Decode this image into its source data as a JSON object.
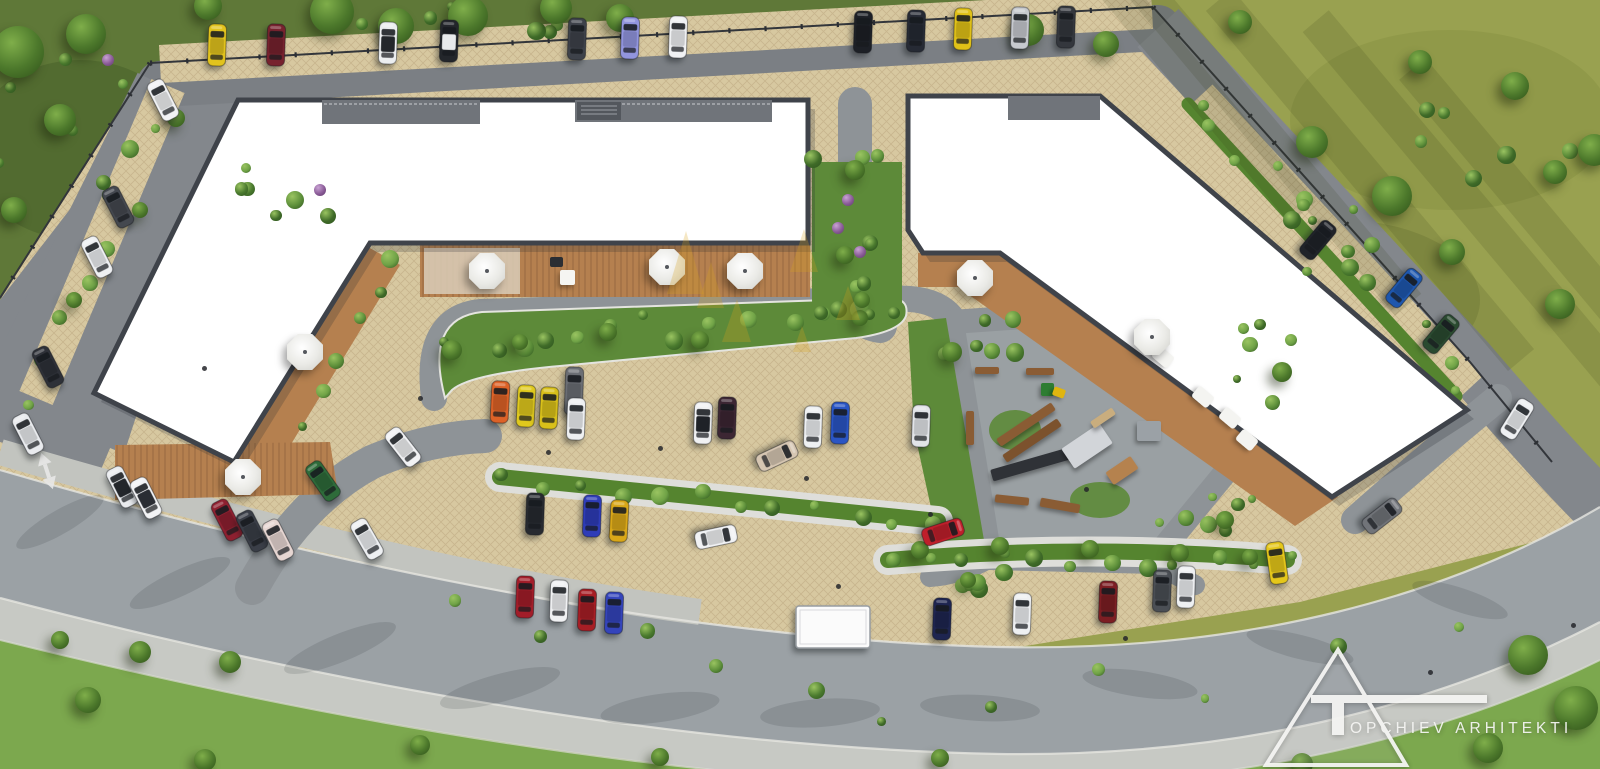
{
  "meta": {
    "width": 1600,
    "height": 769,
    "description": "Aerial 3D site plan rendering of residential complex with parking, gardens and playground"
  },
  "palette": {
    "grass_top_left": "#5f7838",
    "grass_top_right": "#99a150",
    "grass_bottom": "#7ca84e",
    "road_top": "#7b7f84",
    "road": "#83878c",
    "lane": "#8e9397",
    "pad": "#9aa0a3",
    "boulevard": "#9ba1a5",
    "sidewalk": "#c7c9c4",
    "paving": "#d7c8a0",
    "paving_line": "#c3b088",
    "deck": "#b5804f",
    "building": "#ffffff",
    "building_edge": "#3f434a",
    "hedge": "#55842f",
    "garden": "#5d8a39",
    "bush_light": "#9ac461",
    "bush_dark": "#2e531f",
    "flower_purple": "#8a5b97",
    "umbrella": "#f6f6f4",
    "wood": "#8a5c34",
    "watermark": "#d9a41c"
  },
  "logo": {
    "full_name": "TOPCHIEV ARHITEKTI",
    "monogram": "T",
    "text": "OPCHIEV ARHITEKTI"
  },
  "scene": {
    "cars": [
      {
        "x": 217,
        "y": 45,
        "a": 2,
        "c": "#e2c31d"
      },
      {
        "x": 276,
        "y": 45,
        "a": 2,
        "c": "#77222e"
      },
      {
        "x": 388,
        "y": 43,
        "a": 2,
        "c": "#eceef0",
        "r": "#23262b"
      },
      {
        "x": 449,
        "y": 41,
        "a": 2,
        "c": "#23262b",
        "r": "#e8eaec"
      },
      {
        "x": 577,
        "y": 39,
        "a": 2,
        "c": "#3e424a"
      },
      {
        "x": 630,
        "y": 38,
        "a": 2,
        "c": "#9295de"
      },
      {
        "x": 678,
        "y": 37,
        "a": 2,
        "c": "#f0f1f3"
      },
      {
        "x": 863,
        "y": 32,
        "a": 2,
        "c": "#1d2026"
      },
      {
        "x": 916,
        "y": 31,
        "a": 2,
        "c": "#262a34"
      },
      {
        "x": 963,
        "y": 29,
        "a": 2,
        "c": "#e0c117"
      },
      {
        "x": 1020,
        "y": 28,
        "a": 2,
        "c": "#c6c9ce"
      },
      {
        "x": 1066,
        "y": 27,
        "a": 2,
        "c": "#34373d"
      },
      {
        "x": 163,
        "y": 100,
        "a": -27,
        "c": "#f1f2f4"
      },
      {
        "x": 118,
        "y": 207,
        "a": -27,
        "c": "#44484f"
      },
      {
        "x": 97,
        "y": 257,
        "a": -27,
        "c": "#eef0f2"
      },
      {
        "x": 48,
        "y": 367,
        "a": -27,
        "c": "#2e3138"
      },
      {
        "x": 28,
        "y": 434,
        "a": -27,
        "c": "#e9ebee"
      },
      {
        "x": 122,
        "y": 487,
        "a": -27,
        "c": "#eaecef",
        "r": "#23262b"
      },
      {
        "x": 146,
        "y": 498,
        "a": -27,
        "c": "#f2f3f5",
        "r": "#2a2d33"
      },
      {
        "x": 227,
        "y": 520,
        "a": -27,
        "c": "#8e2030"
      },
      {
        "x": 252,
        "y": 531,
        "a": -27,
        "c": "#3a3e47"
      },
      {
        "x": 278,
        "y": 540,
        "a": -27,
        "c": "#e6d6d2"
      },
      {
        "x": 323,
        "y": 481,
        "a": -35,
        "c": "#2e6b3a"
      },
      {
        "x": 403,
        "y": 447,
        "a": -38,
        "c": "#f1f2f4"
      },
      {
        "x": 367,
        "y": 539,
        "a": -30,
        "c": "#eef0f2"
      },
      {
        "x": 500,
        "y": 402,
        "a": 3,
        "c": "#dd6227"
      },
      {
        "x": 526,
        "y": 406,
        "a": 3,
        "c": "#e0c91d"
      },
      {
        "x": 549,
        "y": 408,
        "a": 3,
        "c": "#d9c01a"
      },
      {
        "x": 574,
        "y": 391,
        "a": 2,
        "c": "#6b6e74",
        "h": 48
      },
      {
        "x": 576,
        "y": 419,
        "a": 2,
        "c": "#eef0f2"
      },
      {
        "x": 703,
        "y": 423,
        "a": 2,
        "c": "#f0f1f3",
        "r": "#1f2227"
      },
      {
        "x": 727,
        "y": 418,
        "a": 2,
        "c": "#3c2633"
      },
      {
        "x": 777,
        "y": 456,
        "a": 65,
        "c": "#d6c6b2"
      },
      {
        "x": 813,
        "y": 427,
        "a": 2,
        "c": "#eef0f2"
      },
      {
        "x": 840,
        "y": 423,
        "a": 2,
        "c": "#2a55c4"
      },
      {
        "x": 921,
        "y": 426,
        "a": 2,
        "c": "#e2e4e8"
      },
      {
        "x": 535,
        "y": 514,
        "a": 2,
        "c": "#272a30"
      },
      {
        "x": 592,
        "y": 516,
        "a": 2,
        "c": "#2e3cb8"
      },
      {
        "x": 619,
        "y": 521,
        "a": 3,
        "c": "#d9a718"
      },
      {
        "x": 716,
        "y": 537,
        "a": 78,
        "c": "#f1f2f4"
      },
      {
        "x": 525,
        "y": 597,
        "a": 2,
        "c": "#a21d29"
      },
      {
        "x": 559,
        "y": 601,
        "a": 2,
        "c": "#f0f1f3"
      },
      {
        "x": 587,
        "y": 610,
        "a": 2,
        "c": "#a71e25"
      },
      {
        "x": 614,
        "y": 613,
        "a": 2,
        "c": "#3444bb"
      },
      {
        "x": 942,
        "y": 619,
        "a": 2,
        "c": "#1e2550"
      },
      {
        "x": 1022,
        "y": 614,
        "a": 2,
        "c": "#eef0f2"
      },
      {
        "x": 1108,
        "y": 602,
        "a": 2,
        "c": "#7c1e23"
      },
      {
        "x": 1162,
        "y": 591,
        "a": 2,
        "c": "#4b4f55"
      },
      {
        "x": 1186,
        "y": 587,
        "a": 2,
        "c": "#eef0f2"
      },
      {
        "x": 1277,
        "y": 563,
        "a": -8,
        "c": "#e5c71a"
      },
      {
        "x": 943,
        "y": 532,
        "a": 72,
        "c": "#bf1f2b"
      },
      {
        "x": 833,
        "y": 627,
        "a": 0,
        "c": "#fbfbfb",
        "t": "box",
        "w": 74,
        "h": 42
      },
      {
        "x": 1318,
        "y": 240,
        "a": 40,
        "c": "#202329"
      },
      {
        "x": 1404,
        "y": 288,
        "a": 40,
        "c": "#1e57ae"
      },
      {
        "x": 1441,
        "y": 334,
        "a": 40,
        "c": "#2a4a30"
      },
      {
        "x": 1517,
        "y": 419,
        "a": 32,
        "c": "#eef0f2"
      },
      {
        "x": 1382,
        "y": 516,
        "a": 52,
        "c": "#717479"
      }
    ],
    "umbrellas": [
      {
        "x": 487,
        "y": 271
      },
      {
        "x": 667,
        "y": 267
      },
      {
        "x": 745,
        "y": 271
      },
      {
        "x": 305,
        "y": 352
      },
      {
        "x": 243,
        "y": 477
      },
      {
        "x": 975,
        "y": 278
      },
      {
        "x": 1152,
        "y": 337
      }
    ],
    "tables": [
      {
        "x": 567,
        "y": 277
      }
    ],
    "grills": [
      {
        "x": 556,
        "y": 262
      }
    ],
    "furniture": [
      {
        "x": 1163,
        "y": 357
      },
      {
        "x": 1203,
        "y": 397
      },
      {
        "x": 1230,
        "y": 418
      },
      {
        "x": 1247,
        "y": 440
      }
    ],
    "playground": [
      {
        "x": 1026,
        "y": 424,
        "w": 66,
        "h": 9,
        "a": -34,
        "c": "#8a5c34"
      },
      {
        "x": 1032,
        "y": 440,
        "w": 66,
        "h": 9,
        "a": -34,
        "c": "#7c522d"
      },
      {
        "x": 1036,
        "y": 463,
        "w": 92,
        "h": 12,
        "a": -16,
        "c": "#2f3237"
      },
      {
        "x": 1087,
        "y": 446,
        "w": 46,
        "h": 24,
        "a": -34,
        "c": "#d2d5d9"
      },
      {
        "x": 1122,
        "y": 470,
        "w": 30,
        "h": 15,
        "a": -34,
        "c": "#b5824e"
      },
      {
        "x": 1149,
        "y": 431,
        "w": 24,
        "h": 20,
        "a": 0,
        "c": "#9ba1a6"
      },
      {
        "x": 1047,
        "y": 389,
        "w": 13,
        "h": 13,
        "a": 0,
        "c": "#2e7d32"
      },
      {
        "x": 1059,
        "y": 392,
        "w": 12,
        "h": 9,
        "a": 20,
        "c": "#e0b50f"
      },
      {
        "x": 1012,
        "y": 500,
        "w": 34,
        "h": 8,
        "a": 6,
        "c": "#8a5c34"
      },
      {
        "x": 970,
        "y": 428,
        "w": 8,
        "h": 34,
        "a": 0,
        "c": "#8a5c34"
      },
      {
        "x": 1040,
        "y": 371,
        "w": 28,
        "h": 7,
        "a": 0,
        "c": "#8a5c34"
      },
      {
        "x": 987,
        "y": 370,
        "w": 24,
        "h": 7,
        "a": 0,
        "c": "#8a5c34"
      },
      {
        "x": 1103,
        "y": 418,
        "w": 26,
        "h": 8,
        "a": -34,
        "c": "#c9ad7e"
      },
      {
        "x": 1060,
        "y": 505,
        "w": 40,
        "h": 9,
        "a": 10,
        "c": "#8a5c34"
      }
    ],
    "trees": [
      {
        "x": 332,
        "y": 12,
        "s": 22
      },
      {
        "x": 396,
        "y": 26,
        "s": 18
      },
      {
        "x": 468,
        "y": 16,
        "s": 20
      },
      {
        "x": 556,
        "y": 8,
        "s": 16
      },
      {
        "x": 620,
        "y": 18,
        "s": 14
      },
      {
        "x": 208,
        "y": 6,
        "s": 14
      },
      {
        "x": 18,
        "y": 52,
        "s": 26
      },
      {
        "x": 86,
        "y": 34,
        "s": 20
      },
      {
        "x": 60,
        "y": 120,
        "s": 16
      },
      {
        "x": 14,
        "y": 210,
        "s": 13
      },
      {
        "x": 1028,
        "y": 30,
        "s": 16
      },
      {
        "x": 1106,
        "y": 44,
        "s": 13
      },
      {
        "x": 1392,
        "y": 196,
        "s": 20
      },
      {
        "x": 1312,
        "y": 142,
        "s": 16
      },
      {
        "x": 1452,
        "y": 252,
        "s": 13
      },
      {
        "x": 1560,
        "y": 304,
        "s": 15
      },
      {
        "x": 1515,
        "y": 86,
        "s": 14
      },
      {
        "x": 1420,
        "y": 62,
        "s": 12
      },
      {
        "x": 1594,
        "y": 150,
        "s": 16
      },
      {
        "x": 1240,
        "y": 22,
        "s": 12
      },
      {
        "x": 1555,
        "y": 172,
        "s": 12
      },
      {
        "x": 1528,
        "y": 655,
        "s": 20
      },
      {
        "x": 1576,
        "y": 708,
        "s": 22
      },
      {
        "x": 1488,
        "y": 748,
        "s": 15
      },
      {
        "x": 1302,
        "y": 764,
        "s": 11
      },
      {
        "x": 140,
        "y": 652,
        "s": 11
      },
      {
        "x": 88,
        "y": 700,
        "s": 13
      },
      {
        "x": 60,
        "y": 640,
        "s": 9
      },
      {
        "x": 230,
        "y": 662,
        "s": 11
      },
      {
        "x": 420,
        "y": 745,
        "s": 10
      },
      {
        "x": 660,
        "y": 757,
        "s": 9
      },
      {
        "x": 940,
        "y": 758,
        "s": 9
      },
      {
        "x": 205,
        "y": 760,
        "s": 11
      },
      {
        "x": 452,
        "y": 350,
        "s": 10
      },
      {
        "x": 700,
        "y": 340,
        "s": 9
      },
      {
        "x": 608,
        "y": 332,
        "s": 9
      },
      {
        "x": 520,
        "y": 342,
        "s": 8
      },
      {
        "x": 860,
        "y": 318,
        "s": 8
      },
      {
        "x": 920,
        "y": 550,
        "s": 9
      },
      {
        "x": 1000,
        "y": 546,
        "s": 9
      },
      {
        "x": 1090,
        "y": 549,
        "s": 9
      },
      {
        "x": 1180,
        "y": 553,
        "s": 9
      },
      {
        "x": 1250,
        "y": 557,
        "s": 8
      },
      {
        "x": 176,
        "y": 118,
        "s": 9
      },
      {
        "x": 140,
        "y": 210,
        "s": 8
      },
      {
        "x": 74,
        "y": 300,
        "s": 8
      },
      {
        "x": 952,
        "y": 352,
        "s": 10
      },
      {
        "x": 1282,
        "y": 372,
        "s": 10
      },
      {
        "x": 1225,
        "y": 520,
        "s": 9
      },
      {
        "x": 968,
        "y": 580,
        "s": 8
      },
      {
        "x": 855,
        "y": 170,
        "s": 10
      },
      {
        "x": 845,
        "y": 255,
        "s": 9
      },
      {
        "x": 862,
        "y": 300,
        "s": 8
      }
    ],
    "bush_clusters": [
      {
        "x": 60,
        "y": 80,
        "rx": 120,
        "ry": 110,
        "n": 10
      },
      {
        "x": 480,
        "y": 20,
        "rx": 190,
        "ry": 14,
        "n": 8
      },
      {
        "x": 852,
        "y": 235,
        "rx": 40,
        "ry": 80,
        "n": 10
      },
      {
        "line": [
          455,
          345,
          885,
          315
        ],
        "n": 14,
        "w": 16
      },
      {
        "line": [
          505,
          477,
          935,
          521
        ],
        "n": 12,
        "w": 8
      },
      {
        "line": [
          890,
          558,
          1285,
          562
        ],
        "n": 12,
        "w": 8
      },
      {
        "line": [
          1195,
          100,
          1465,
          390
        ],
        "n": 12,
        "w": 14
      },
      {
        "line": [
          150,
          120,
          30,
          400
        ],
        "n": 8,
        "w": 12
      },
      {
        "x": 975,
        "y": 350,
        "rx": 40,
        "ry": 35,
        "n": 7
      },
      {
        "x": 1215,
        "y": 515,
        "rx": 70,
        "ry": 28,
        "n": 7
      },
      {
        "x": 950,
        "y": 582,
        "rx": 55,
        "ry": 16,
        "n": 5
      },
      {
        "x": 1272,
        "y": 360,
        "rx": 35,
        "ry": 45,
        "n": 6
      },
      {
        "x": 1340,
        "y": 240,
        "rx": 60,
        "ry": 60,
        "n": 6
      },
      {
        "x": 1500,
        "y": 120,
        "rx": 80,
        "ry": 80,
        "n": 6
      },
      {
        "x": 300,
        "y": 180,
        "rx": 60,
        "ry": 60,
        "n": 6
      },
      {
        "line": [
          390,
          250,
          300,
          420
        ],
        "n": 6,
        "w": 10
      },
      {
        "line": [
          430,
          620,
          900,
          700
        ],
        "n": 6,
        "w": 30
      },
      {
        "line": [
          1000,
          700,
          1450,
          650
        ],
        "n": 5,
        "w": 25
      }
    ],
    "flowers": [
      {
        "x": 848,
        "y": 200
      },
      {
        "x": 838,
        "y": 228
      },
      {
        "x": 860,
        "y": 252
      },
      {
        "x": 108,
        "y": 60
      },
      {
        "x": 320,
        "y": 190
      }
    ],
    "dots": [
      {
        "x": 548,
        "y": 452
      },
      {
        "x": 806,
        "y": 478
      },
      {
        "x": 930,
        "y": 514
      },
      {
        "x": 1086,
        "y": 489
      },
      {
        "x": 660,
        "y": 448
      },
      {
        "x": 420,
        "y": 398
      },
      {
        "x": 113,
        "y": 470
      },
      {
        "x": 1125,
        "y": 638
      },
      {
        "x": 838,
        "y": 586
      },
      {
        "x": 1430,
        "y": 672
      },
      {
        "x": 1573,
        "y": 625
      },
      {
        "x": 204,
        "y": 368
      }
    ],
    "watermark_triangles": [
      [
        667,
        294,
        686,
        231,
        704,
        294
      ],
      [
        697,
        308,
        711,
        262,
        724,
        308
      ],
      [
        790,
        272,
        804,
        229,
        818,
        272
      ],
      [
        722,
        342,
        737,
        299,
        751,
        342
      ],
      [
        793,
        352,
        802,
        326,
        811,
        352
      ],
      [
        836,
        320,
        848,
        286,
        860,
        320
      ]
    ],
    "stripe_shadows": [
      {
        "x": 1200,
        "y": 90,
        "l": 320,
        "a": 50
      },
      {
        "x": 1270,
        "y": 140,
        "l": 430,
        "a": 50
      },
      {
        "x": 1370,
        "y": 180,
        "l": 470,
        "a": 50
      },
      {
        "x": 1470,
        "y": 205,
        "l": 480,
        "a": 50
      },
      {
        "x": 1560,
        "y": 245,
        "l": 460,
        "a": 50
      }
    ],
    "road_shadows": [
      {
        "x": 180,
        "y": 583,
        "rx": 55,
        "ry": 13,
        "a": -25
      },
      {
        "x": 340,
        "y": 648,
        "rx": 60,
        "ry": 14,
        "a": -22
      },
      {
        "x": 500,
        "y": 688,
        "rx": 62,
        "ry": 14,
        "a": -15
      },
      {
        "x": 660,
        "y": 708,
        "rx": 60,
        "ry": 14,
        "a": -8
      },
      {
        "x": 820,
        "y": 713,
        "rx": 60,
        "ry": 14,
        "a": -4
      },
      {
        "x": 980,
        "y": 708,
        "rx": 60,
        "ry": 13,
        "a": 3
      },
      {
        "x": 1140,
        "y": 684,
        "rx": 58,
        "ry": 13,
        "a": 8
      },
      {
        "x": 1300,
        "y": 647,
        "rx": 55,
        "ry": 12,
        "a": 14
      },
      {
        "x": 60,
        "y": 522,
        "rx": 50,
        "ry": 12,
        "a": -30
      },
      {
        "x": 1460,
        "y": 600,
        "rx": 50,
        "ry": 12,
        "a": 18
      }
    ]
  }
}
